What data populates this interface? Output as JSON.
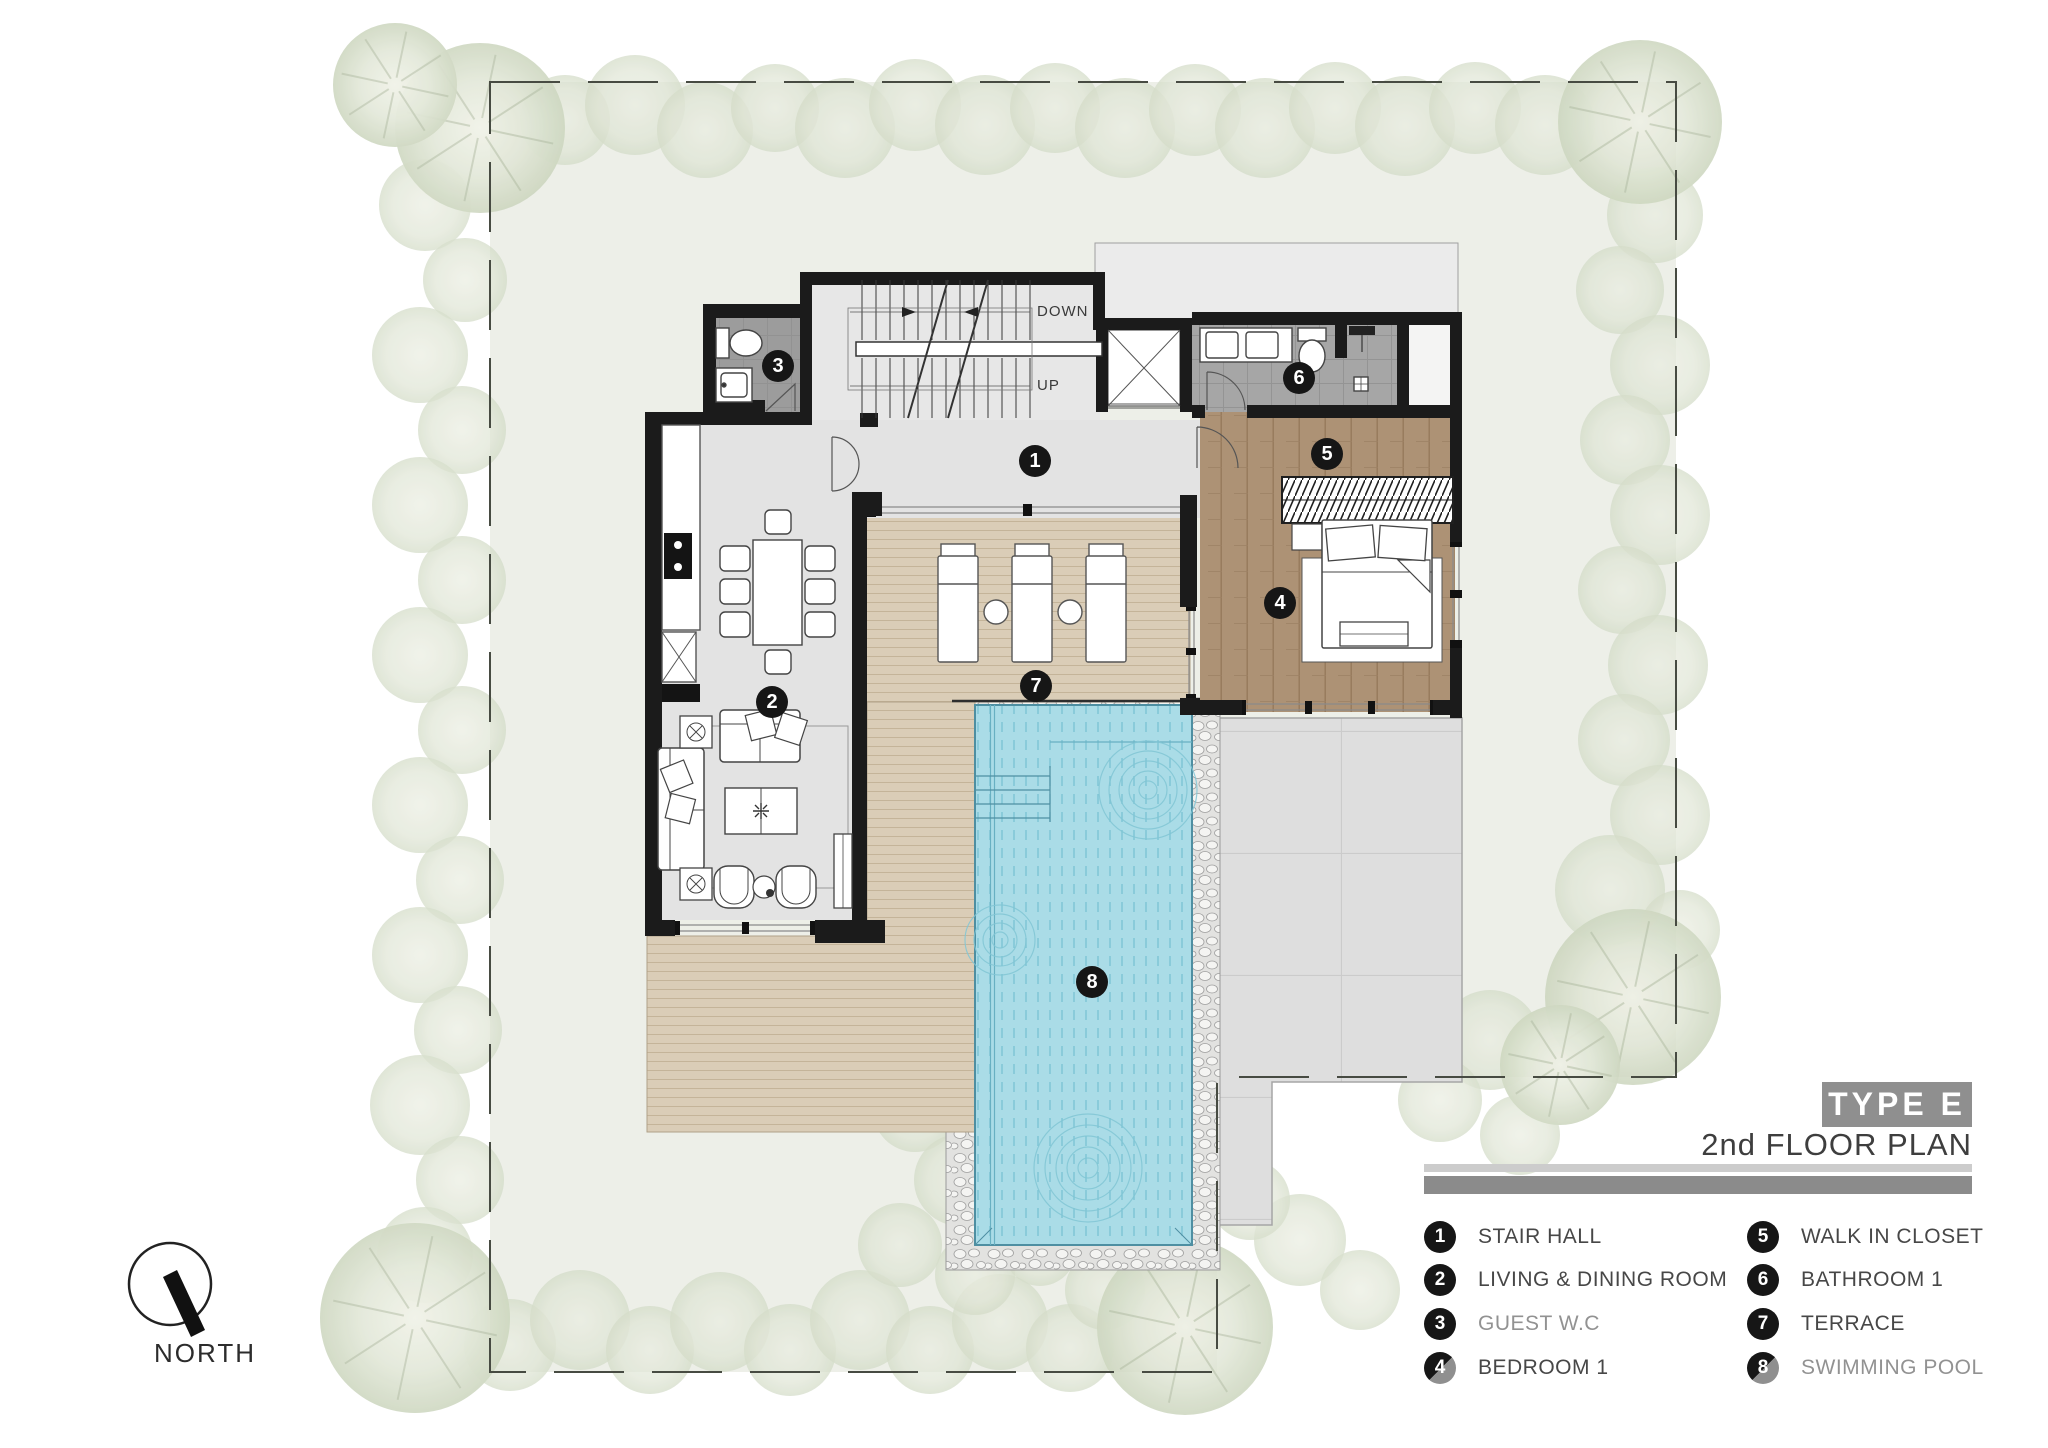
{
  "colors": {
    "pool_water": "#aadce7",
    "deck_wood": "#dacdb7",
    "bedroom_wood": "#ad9275",
    "wall_black": "#1b1b1b",
    "site_green": "#edefe8",
    "title_gray": "#8f8f8f"
  },
  "plan": {
    "stair_down_label": "DOWN",
    "stair_up_label": "UP"
  },
  "compass": {
    "label": "NORTH"
  },
  "title_block": {
    "type_label": "TYPE E",
    "floor_label": "2nd FLOOR PLAN"
  },
  "markers": [
    "1",
    "2",
    "3",
    "4",
    "5",
    "6",
    "7",
    "8"
  ],
  "legend": {
    "items": [
      {
        "num": "1",
        "label": "STAIR HALL",
        "muted": false,
        "badge_split": false
      },
      {
        "num": "2",
        "label": "LIVING & DINING ROOM",
        "muted": false,
        "badge_split": false
      },
      {
        "num": "3",
        "label": "GUEST W.C",
        "muted": true,
        "badge_split": false
      },
      {
        "num": "4",
        "label": "BEDROOM 1",
        "muted": false,
        "badge_split": true
      },
      {
        "num": "5",
        "label": "WALK IN CLOSET",
        "muted": false,
        "badge_split": false
      },
      {
        "num": "6",
        "label": "BATHROOM 1",
        "muted": false,
        "badge_split": false
      },
      {
        "num": "7",
        "label": "TERRACE",
        "muted": false,
        "badge_split": false
      },
      {
        "num": "8",
        "label": "SWIMMING POOL",
        "muted": true,
        "badge_split": true
      }
    ]
  }
}
